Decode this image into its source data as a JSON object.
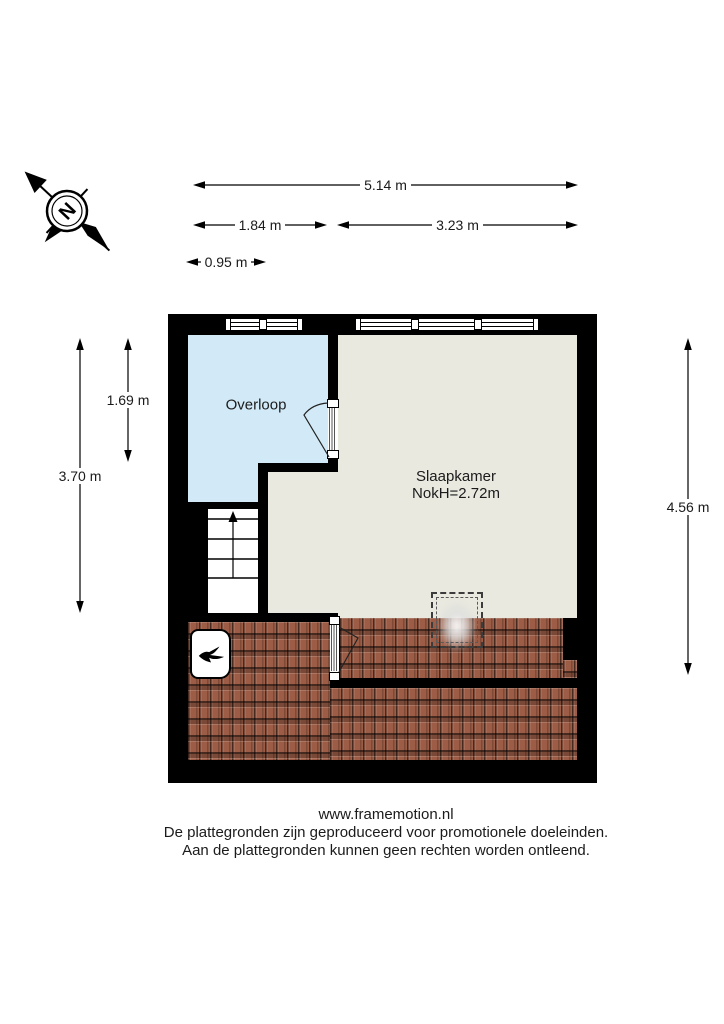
{
  "compass": {
    "north_label": "N"
  },
  "dimensions": {
    "width_total": "5.14 m",
    "width_overloop": "1.84 m",
    "width_slaapkamer": "3.23 m",
    "width_stairs": "0.95 m",
    "height_left_total": "3.70 m",
    "height_overloop": "1.69 m",
    "height_right": "4.56 m"
  },
  "rooms": {
    "overloop": {
      "name": "Overloop"
    },
    "slaapkamer": {
      "name": "Slaapkamer",
      "ridge_height": "NokH=2.72m"
    }
  },
  "footer": {
    "website": "www.framemotion.nl",
    "disclaimer1": "De plattegronden zijn geproduceerd voor promotionele doeleinden.",
    "disclaimer2": "Aan de plattegronden kunnen geen rechten worden ontleend."
  },
  "colors": {
    "wall": "#000000",
    "overloop_fill": "#d2eaf7",
    "slaapkamer_fill": "#e9e9e0",
    "roof_tile": "#9c5c45"
  }
}
